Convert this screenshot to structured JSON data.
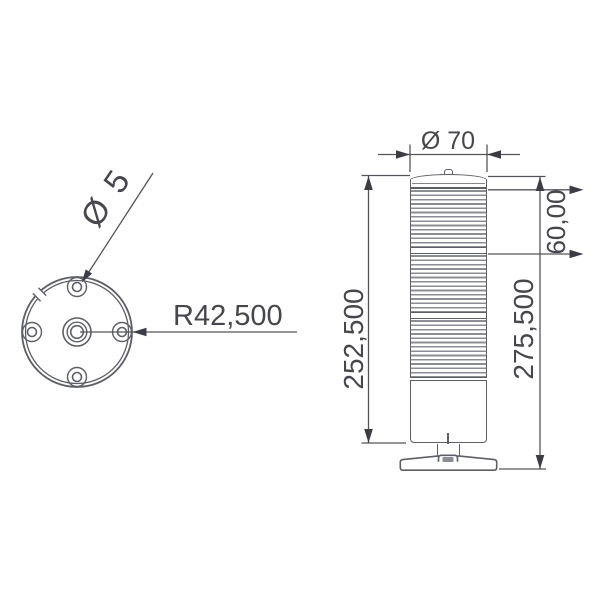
{
  "drawing": {
    "type": "technical-drawing-signal-tower",
    "colors": {
      "background": "#ffffff",
      "outline": "#5d5f66",
      "dimension_line": "#54555c",
      "arrow": "#3c3d44",
      "text": "#46474d",
      "rib": "#8b8d94"
    },
    "top_view": {
      "hole_diameter_label": "Ø 5",
      "bolt_circle_radius_label": "R42,500"
    },
    "side_view": {
      "diameter_label": "Ø 70",
      "top_segment_height_label": "60,00",
      "body_height_label": "252,500",
      "total_height_label": "275,500"
    }
  }
}
